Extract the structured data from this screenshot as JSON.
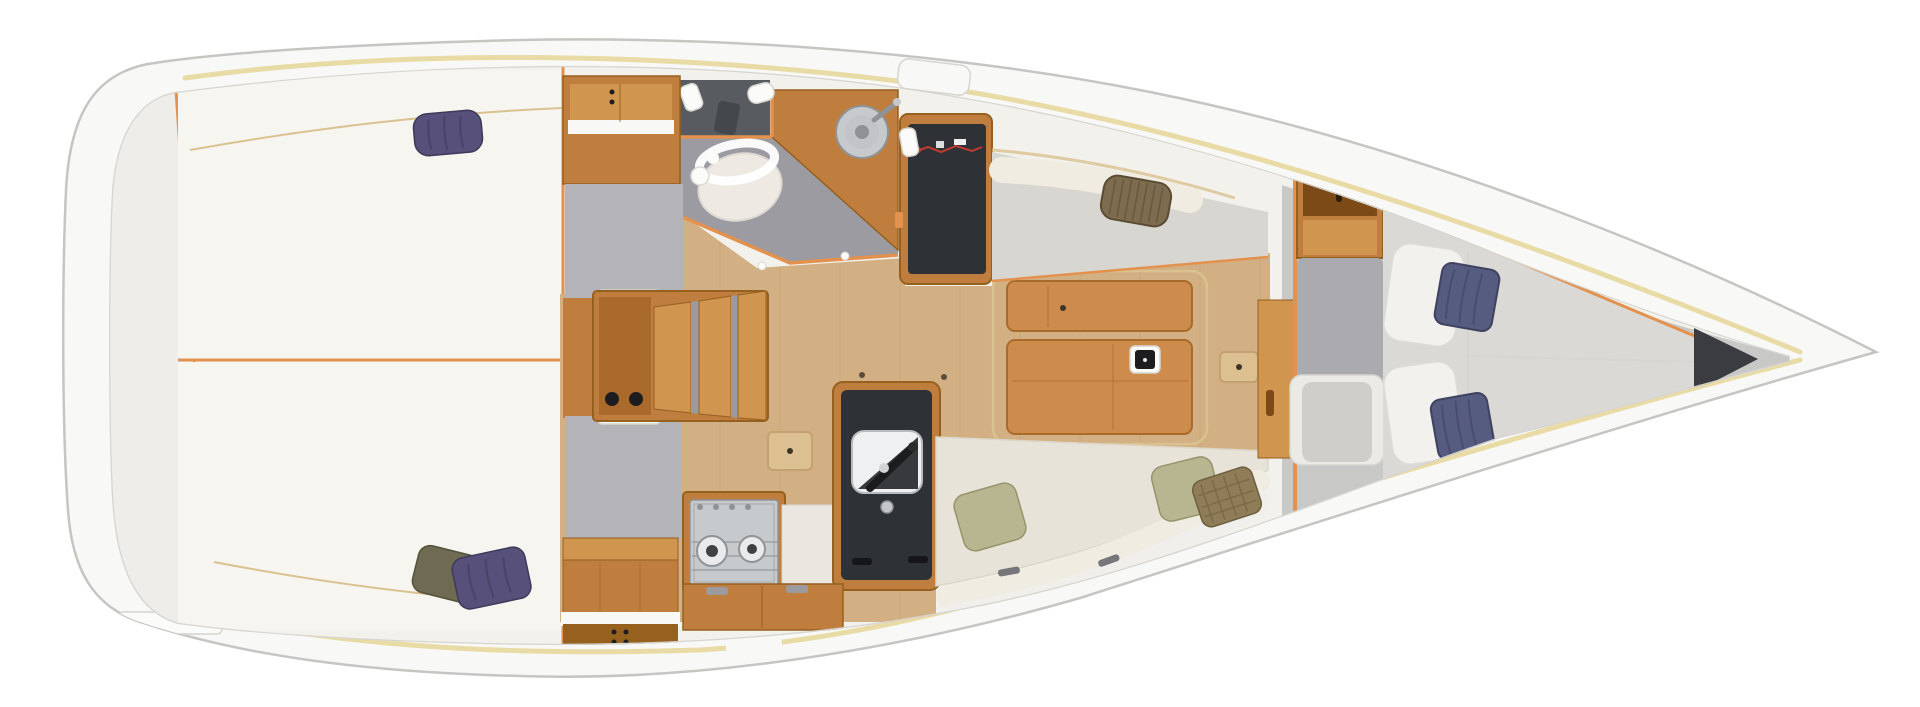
{
  "diagram": {
    "type": "boat-interior-floor-plan",
    "view": "top-down",
    "canvas": {
      "width": 1920,
      "height": 707
    }
  },
  "regions": {
    "hull": {
      "label": "Hull and side decks"
    },
    "stern_platform": {
      "label": "Stern platform and transom locker"
    },
    "aft_cabin_starboard": {
      "label": "Aft double berth cabin (starboard)"
    },
    "aft_cabin_port": {
      "label": "Aft double berth cabin (port)"
    },
    "aft_wardrobe": {
      "label": "Aft wardrobe cabinet"
    },
    "companionway": {
      "label": "Companionway steps"
    },
    "head": {
      "label": "Head compartment with marine toilet and washbasin"
    },
    "galley": {
      "label": "Galley with two-burner stove and sink"
    },
    "nav_station": {
      "label": "Chart table with electrical panel"
    },
    "saloon": {
      "label": "Saloon with folding table"
    },
    "settee_starboard": {
      "label": "Starboard settee"
    },
    "settee_port": {
      "label": "Port settee with stowage drawers"
    },
    "forward_cabin": {
      "label": "Forward V-berth cabin"
    },
    "anchor_locker": {
      "label": "Anchor locker"
    }
  },
  "colors": {
    "pagebg": "#ffffff",
    "hullfill": "#f8f8f6",
    "hullstroke": "#c5c5c1",
    "rail": "#e9dba6",
    "innerline": "#d6d5d0",
    "interior": "#f3f1ec",
    "stern": "#eeedea",
    "berth": "#f7f5f0",
    "hairline": "#d9c290",
    "floor": "#d3b083",
    "grain": "#bd9a6a",
    "wood": "#bf7e3d",
    "wooddark": "#96601f",
    "woodlight": "#d0954f",
    "wooddeep": "#7c4a17",
    "tablewood": "#cd8c4b",
    "tableline": "#a96b2b",
    "trim": "#e2924e",
    "grayfloor": "#9b9ba1",
    "alcove": "#585c60",
    "entry": "#b4b4b8",
    "corridor": "#ababaf",
    "mattress": "#dad9d5",
    "settee": "#d8d6d0",
    "cushion": "#e7e3d9",
    "bolster": "#f0ece1",
    "drawer": "#f0efec",
    "blackcounter": "#2e3135",
    "steel": "#c7cacd",
    "steeldark": "#8f9296",
    "toilet": "#efe9e3",
    "white": "#fbfbfa",
    "door": "#f8f8f6",
    "doorline": "#d6d5cf",
    "blackline": "#1b1c1e",
    "creamline": "#dcd6c8",
    "navy": "#565b80",
    "navydark": "#3f4360",
    "purple": "#56507a",
    "purpledark": "#3e3a59",
    "olive": "#6f6b52",
    "olivedark": "#54513c",
    "green": "#b7b690",
    "greendark": "#95946c",
    "wicker": "#7d6c4e",
    "wickerdark": "#5a4c34",
    "plaid": "#8f7d57",
    "plaiddark": "#6e5e3f",
    "darklocker": "#3a3c40",
    "wire": "#c23a30",
    "dot": "#3c3428",
    "hatch": "#dcc091",
    "hatchline": "#c2a26e"
  }
}
